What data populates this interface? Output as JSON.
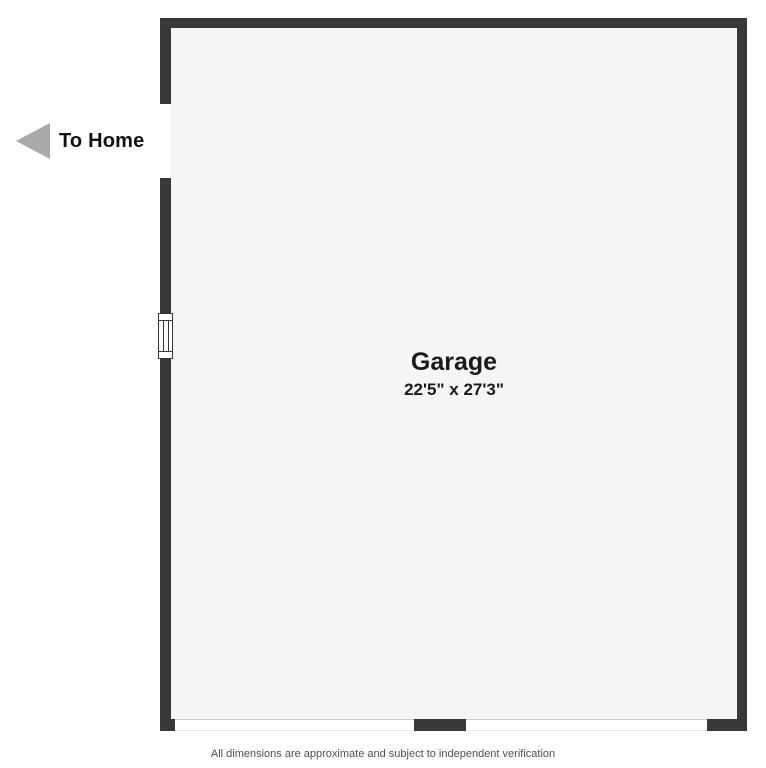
{
  "floorplan": {
    "exit": {
      "label": "To Home"
    },
    "room": {
      "name": "Garage",
      "dimensions": "22'5\" x 27'3\""
    },
    "disclaimer": "All dimensions are approximate and subject to independent verification",
    "colors": {
      "wall": "#383838",
      "floor": "#f5f5f5",
      "background": "#ffffff",
      "arrow": "#a9a9a9",
      "disclaimer_text": "#4f4f4f"
    }
  }
}
